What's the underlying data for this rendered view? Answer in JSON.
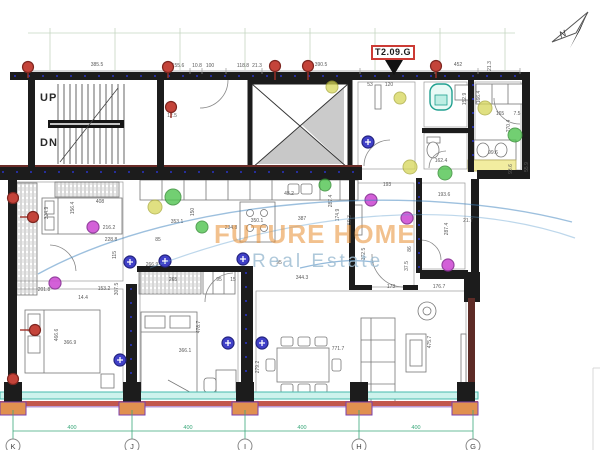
{
  "title": {
    "unit_label": "T2.09.G"
  },
  "compass": {
    "north": "N"
  },
  "stairs": {
    "up": "UP",
    "down": "DN"
  },
  "watermark": {
    "line1": "FUTURE HOME",
    "line2": "Real Estate"
  },
  "grid": {
    "letters": [
      "K",
      "J",
      "I",
      "H",
      "G"
    ],
    "spans": [
      "400",
      "400",
      "400",
      "400"
    ]
  },
  "dims": [
    {
      "t": "385.5"
    },
    {
      "t": "155.6"
    },
    {
      "t": "10.8"
    },
    {
      "t": "100"
    },
    {
      "t": "118.8"
    },
    {
      "t": "21.3"
    },
    {
      "t": "390.5"
    },
    {
      "t": "452"
    },
    {
      "t": "21.3"
    },
    {
      "t": "53"
    },
    {
      "t": "120"
    },
    {
      "t": "12.5"
    },
    {
      "t": "152.9"
    },
    {
      "t": "166.4"
    },
    {
      "t": "165"
    },
    {
      "t": "7.5"
    },
    {
      "t": "270.4"
    },
    {
      "t": "99.6"
    },
    {
      "t": "93.6"
    },
    {
      "t": "55.9"
    },
    {
      "t": "162.4"
    },
    {
      "t": "408"
    },
    {
      "t": "156.4"
    },
    {
      "t": "324.9"
    },
    {
      "t": "350.1"
    },
    {
      "t": "387"
    },
    {
      "t": "48.2"
    },
    {
      "t": "150"
    },
    {
      "t": "59.3"
    },
    {
      "t": "216.2"
    },
    {
      "t": "228.8"
    },
    {
      "t": "234.8"
    },
    {
      "t": "353.1"
    },
    {
      "t": "85"
    },
    {
      "t": "115"
    },
    {
      "t": "172.5"
    },
    {
      "t": "344.3"
    },
    {
      "t": "266.9"
    },
    {
      "t": "265"
    },
    {
      "t": "95"
    },
    {
      "t": "95"
    },
    {
      "t": "15"
    },
    {
      "t": "14.4"
    },
    {
      "t": "307.5"
    },
    {
      "t": "153.2"
    },
    {
      "t": "201.8"
    },
    {
      "t": "193"
    },
    {
      "t": "287.4"
    },
    {
      "t": "174.9"
    },
    {
      "t": "287.4"
    },
    {
      "t": "193.6"
    },
    {
      "t": "21.7"
    },
    {
      "t": "86"
    },
    {
      "t": "37.5"
    },
    {
      "t": "366.9"
    },
    {
      "t": "466.6"
    },
    {
      "t": "366.1"
    },
    {
      "t": "478.7"
    },
    {
      "t": "279.2"
    },
    {
      "t": "771.7"
    },
    {
      "t": "475.7"
    },
    {
      "t": "173"
    },
    {
      "t": "176.7"
    }
  ],
  "colors": {
    "wall": "#1c1c1c",
    "label_box_red": "#cc3b35",
    "marker_red": "#c4443a",
    "marker_green": "#4fc44f",
    "marker_yellow": "#d6d657",
    "marker_magenta": "#cf4fd4",
    "marker_blue": "#4040c8",
    "window_band": "#cdf2ec",
    "sill_red": "#c2574d",
    "frame_orange": "#e09050",
    "grid_green": "#3aa87a",
    "watermark_orange": "#e8943c",
    "watermark_blue": "#a0bed4",
    "boiler_teal": "#20a090"
  }
}
